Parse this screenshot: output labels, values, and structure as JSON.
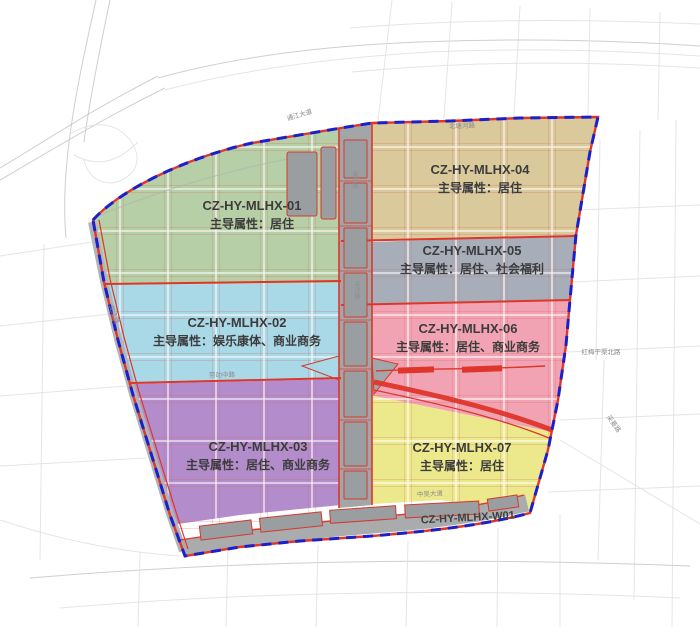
{
  "map": {
    "zones": [
      {
        "code": "CZ-HY-MLHX-01",
        "attribute": "主导属性：居住",
        "color": "#b6cfa7"
      },
      {
        "code": "CZ-HY-MLHX-02",
        "attribute": "主导属性：娱乐康体、商业商务",
        "color": "#a9d8e6"
      },
      {
        "code": "CZ-HY-MLHX-03",
        "attribute": "主导属性：居住、商业商务",
        "color": "#b38ccb"
      },
      {
        "code": "CZ-HY-MLHX-04",
        "attribute": "主导属性：居住",
        "color": "#d9c99b"
      },
      {
        "code": "CZ-HY-MLHX-05",
        "attribute": "主导属性：居住、社会福利",
        "color": "#a7aeba"
      },
      {
        "code": "CZ-HY-MLHX-06",
        "attribute": "主导属性：居住、商业商务",
        "color": "#f2a3b3"
      },
      {
        "code": "CZ-HY-MLHX-07",
        "attribute": "主导属性：居住",
        "color": "#ece98d"
      },
      {
        "code": "CZ-HY-MLHX-W01",
        "attribute": "",
        "color": "#a9abad"
      }
    ],
    "road_labels": [
      {
        "text": "通江大道"
      },
      {
        "text": "北塘河路"
      },
      {
        "text": "红梅干渠北路"
      },
      {
        "text": "采菱路"
      },
      {
        "text": "中吴大道"
      },
      {
        "text": "龙江路"
      },
      {
        "text": "青洋路"
      },
      {
        "text": "劳动中路"
      }
    ],
    "colors": {
      "boundary_blue": "#1d1fc9",
      "road_red": "#de362b",
      "background": "#ffffff",
      "outside_roads": "#c7c7c7",
      "label_text": "#3c3c3c"
    }
  }
}
